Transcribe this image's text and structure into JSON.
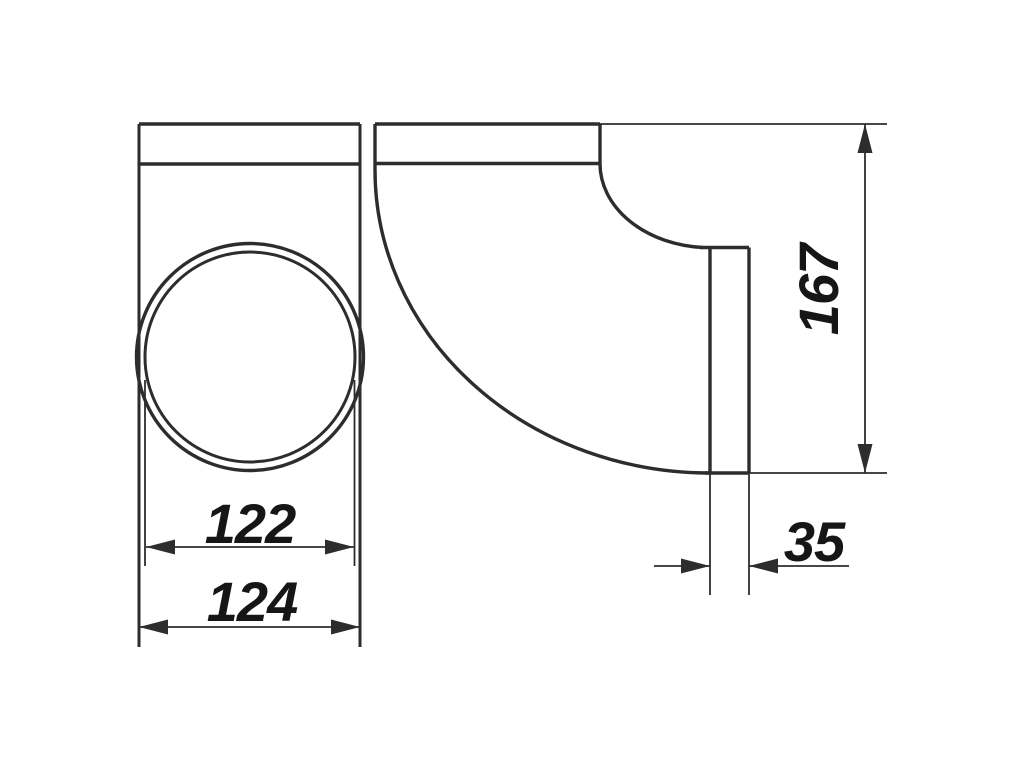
{
  "dimensions": {
    "inner_diameter": "122",
    "outer_width": "124",
    "overall_height": "167",
    "connector_depth": "35"
  },
  "colors": {
    "line": "#2d2d2d",
    "text": "#161616",
    "background": "#ffffff"
  }
}
